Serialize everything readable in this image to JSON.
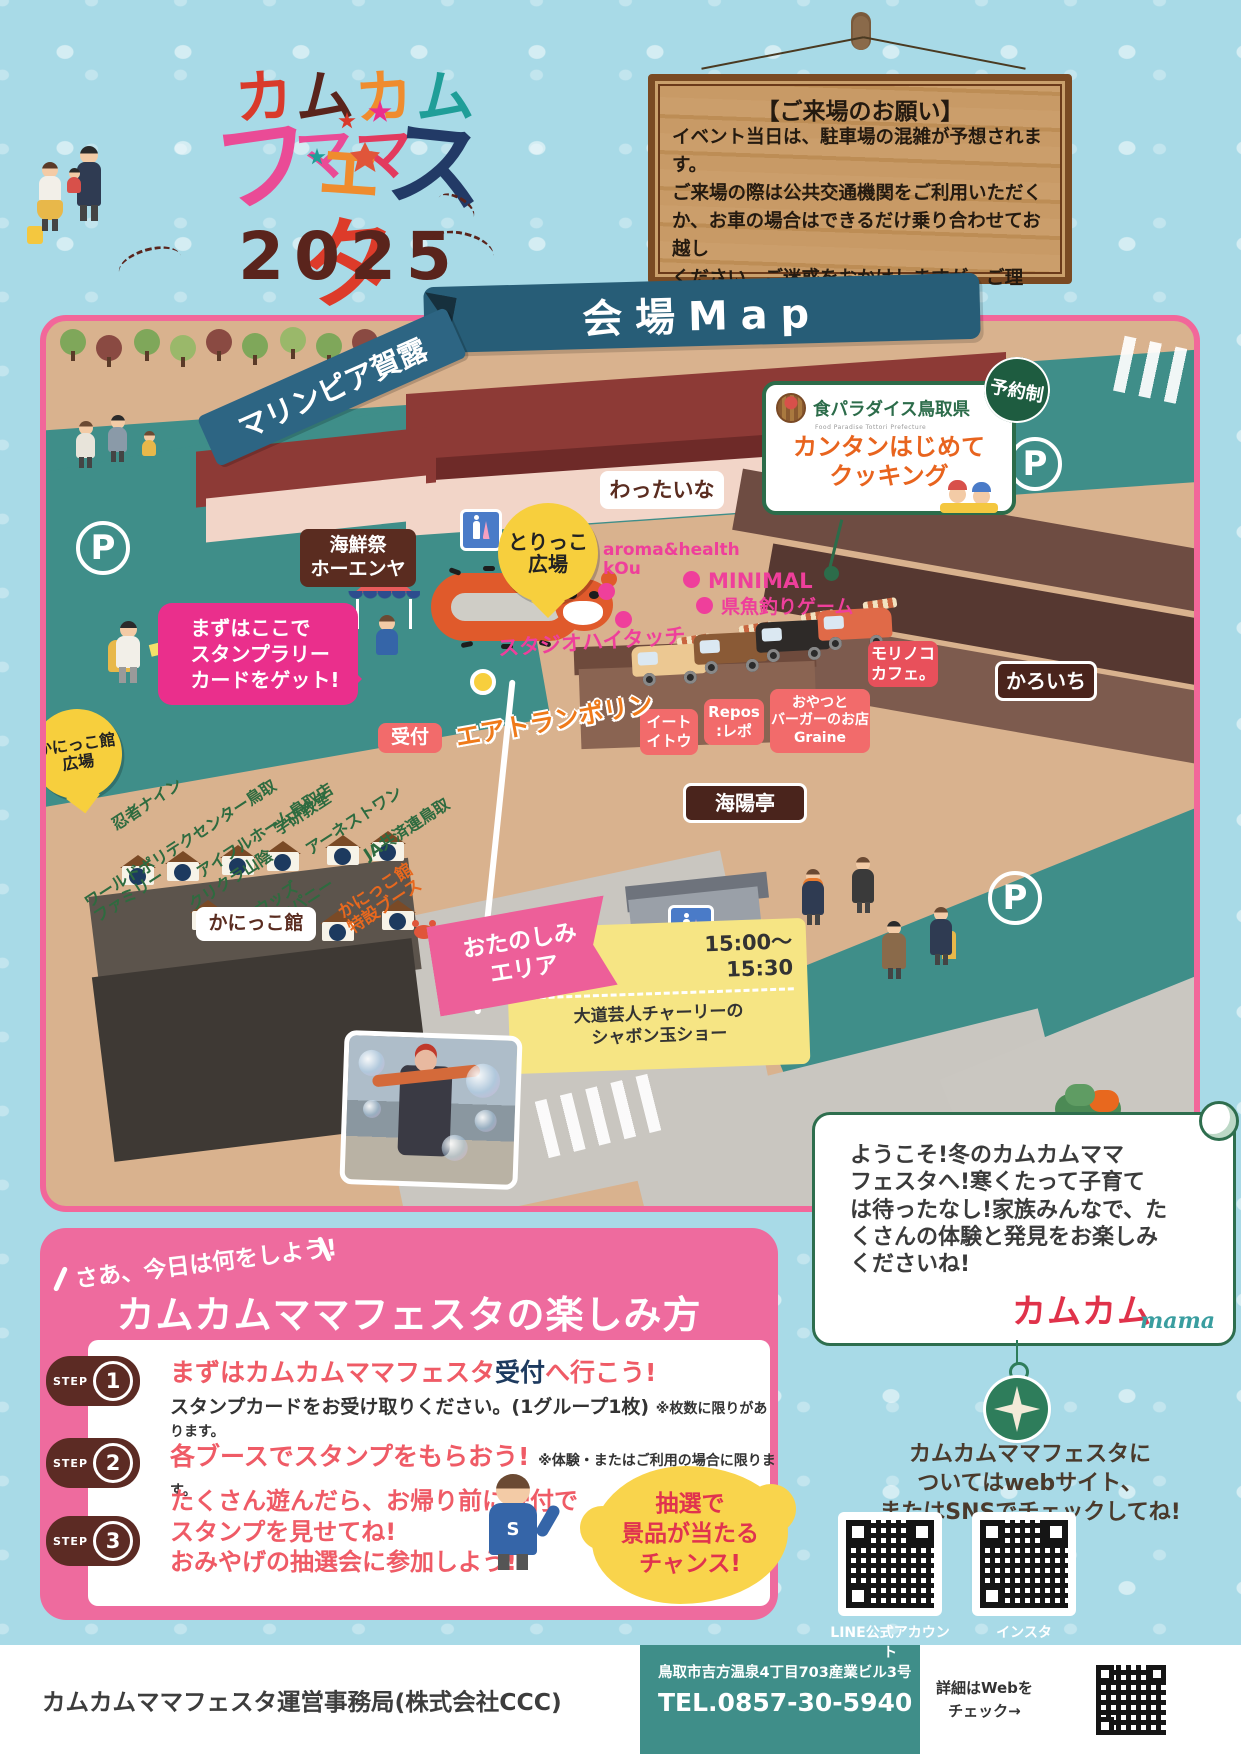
{
  "colors": {
    "background_blue": "#a8dae7",
    "frame_pink": "#f2679a",
    "ground_teal": "#3f8e89",
    "map_tan": "#d9b28e",
    "howto_pink": "#ee6b9e",
    "step_maroon": "#5c2b24",
    "step_title_red": "#ef5b66",
    "truck_label_red": "#f26b6b",
    "booth_label_green": "#2e6b3f",
    "marker_pink": "#ef3f9b",
    "cooking_green": "#2c6c4a",
    "prize_yellow": "#f9d44c",
    "balloon_yellow": "#f7cf3d"
  },
  "header": {
    "logo_line1": [
      {
        "ch": "カ",
        "c": "#d93a2b"
      },
      {
        "ch": "ム",
        "c": "#5a241c"
      },
      {
        "ch": "カ",
        "c": "#ef8c2e"
      },
      {
        "ch": "ム",
        "c": "#1f9e98"
      },
      {
        "ch": "マ",
        "c": "#ea4b96"
      },
      {
        "ch": "マ",
        "c": "#e23a5e"
      }
    ],
    "logo_line2": [
      {
        "ch": "フ",
        "c": "#ea4b96"
      },
      {
        "ch": "ェ",
        "c": "#ef8c2e"
      },
      {
        "ch": "ス",
        "c": "#223a66"
      },
      {
        "ch": "タ",
        "c": "#dd3b2a"
      }
    ],
    "year": "2025",
    "notice_title": "【ご来場のお願い】",
    "notice_body": "イベント当日は、駐車場の混雑が予想されます。\nご来場の際は公共交通機関をご利用いただく\nか、お車の場合はできるだけ乗り合わせてお越し\nください。ご迷惑をおかけしますが、ご理解・ご\n協力のほど、よろしくお願い申し上げます。"
  },
  "map": {
    "banner": "会場Map",
    "venue": "マリンピア賀露",
    "parking": "P",
    "cooking": {
      "brand": "食パラダイス鳥取県",
      "brand_sub": "Food Paradise Tottori Prefecture",
      "badge": "予約制",
      "title": "カンタンはじめて\nクッキング"
    },
    "labels": {
      "wattaina": "わったいな",
      "kaisensai": "海鮮祭\nホーエンヤ",
      "torikko": "とりっこ\n広場",
      "aroma": "aroma&health\nkOu",
      "minimal": "MINIMAL",
      "fishing": "県魚釣りゲーム",
      "studio": "スタジオハイタッチ",
      "morinoko": "モリノコ\nカフェ。",
      "karoichi": "かろいち",
      "stamp": "まずはここで\nスタンプラリー\nカードをゲット!",
      "reception": "受付",
      "trampoline": "エアトランポリン",
      "eatito": "イート\nイトウ",
      "repos": "Repos\n:レポ",
      "graine": "おやつと\nバーガーのお店\nGraine",
      "kaiyotei": "海陽亭",
      "kanikko_hiroba": "かにっこ館\n広場",
      "kanikko_kan": "かにっこ館",
      "otanoshimi": "おたのしみ\nエリア"
    },
    "booths": [
      "忍者ナイン",
      "ポリテクセンター鳥取",
      "アイフルホーム鳥取店",
      "学研教室",
      "アーネストワン",
      "JA共済連鳥取",
      "ワールド\nファミリー",
      "クリクラ山陰",
      "ウッズ\nカンパニー",
      "かにっこ館\n特設ブース"
    ],
    "event": {
      "time": "15:00〜\n15:30",
      "title": "大道芸人チャーリーの\nシャボン玉ショー"
    }
  },
  "welcome": {
    "text": "ようこそ!冬のカムカムママ\nフェスタへ!寒くたって子育て\nは待ったなし!家族みんなで、た\nくさんの体験と発見をお楽しみ\nくださいね!",
    "logo_main": "カムカム",
    "logo_sub": "mama"
  },
  "howto": {
    "kicker": "さあ、今日は何をしよう!",
    "title": "カムカムママフェスタの楽しみ方",
    "steps": [
      {
        "label": "STEP",
        "num": "1",
        "t1": "まずはカムカムママフェスタ",
        "t_em": "受付",
        "t2": "へ行こう!",
        "desc": "スタンプカードをお受け取りください。(1グループ1枚)",
        "note": "※枚数に限りがあります。"
      },
      {
        "label": "STEP",
        "num": "2",
        "t1": "各ブースでスタンプをもらおう!",
        "note": "※体験・またはご利用の場合に限ります。"
      },
      {
        "label": "STEP",
        "num": "3",
        "t1": "たくさん遊んだら、お帰り前に受付で\nスタンプを見せてね!\nおみやげの抽選会に参加しよう!"
      }
    ],
    "prize": "抽選で\n景品が当たる\nチャンス!"
  },
  "sns": {
    "text": "カムカムママフェスタに\nついてはwebサイト、\nまたはSNSでチェックしてね!",
    "qr1_label": "LINE公式アカウント",
    "qr2_label": "インスタ"
  },
  "footer": {
    "org": "カムカムママフェスタ運営事務局(株式会社CCC)",
    "address": "鳥取市吉方温泉4丁目703産業ビル3号",
    "tel": "TEL.0857-30-5940",
    "web": "詳細はWebを\nチェック→"
  }
}
